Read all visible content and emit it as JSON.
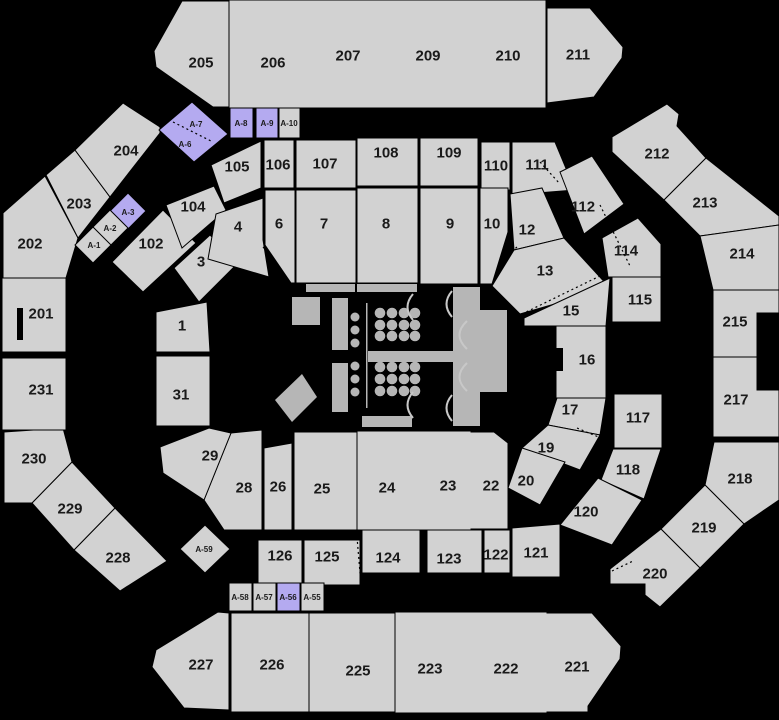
{
  "canvas": {
    "w": 779,
    "h": 720,
    "bg": "#000000"
  },
  "colors": {
    "g": "#d2d2d2",
    "p": "#b4aaf0",
    "stage": "#b6b6b6",
    "arc": "#c8c8c8",
    "label": "#1a1a1a",
    "border": "#000000"
  },
  "sections": [
    {
      "id": "205",
      "label": "205",
      "pts": "182,1 229,1 229,107 213,107 156,67 154,51",
      "lx": 201,
      "ly": 62,
      "fs": 15,
      "fill": "g"
    },
    {
      "id": "206",
      "label": "206",
      "pts": "230,1 310,1 310,107 230,107",
      "lx": 273,
      "ly": 62,
      "fs": 15,
      "fill": "g",
      "st": false
    },
    {
      "id": "207",
      "label": "207",
      "pts": "310,1 390,1 390,107 310,107",
      "lx": 348,
      "ly": 55,
      "fs": 15,
      "fill": "g",
      "st": false
    },
    {
      "id": "209",
      "label": "209",
      "pts": "390,1 465,1 465,107 390,107",
      "lx": 428,
      "ly": 55,
      "fs": 15,
      "fill": "g",
      "st": false
    },
    {
      "id": "210",
      "label": "210",
      "pts": "465,1 545,1 545,107 465,107",
      "lx": 508,
      "ly": 55,
      "fs": 15,
      "fill": "g",
      "st": false
    },
    {
      "id": "211",
      "label": "211",
      "pts": "547,8 590,8 623,47 622,58 594,97 547,103",
      "lx": 578,
      "ly": 54,
      "fs": 15,
      "fill": "g"
    },
    {
      "id": "212",
      "label": "212",
      "pts": "612,137 667,104 679,114 677,126 706,158 664,200 612,152",
      "lx": 657,
      "ly": 153,
      "fs": 15,
      "fill": "g"
    },
    {
      "id": "213",
      "label": "213",
      "pts": "706,158 664,200 700,236 779,225 779,216",
      "lx": 705,
      "ly": 202,
      "fs": 15,
      "fill": "g"
    },
    {
      "id": "214",
      "label": "214",
      "pts": "700,236 779,225 779,290 713,290",
      "lx": 742,
      "ly": 253,
      "fs": 15,
      "fill": "g"
    },
    {
      "id": "215",
      "label": "215",
      "pts": "713,290 779,290 779,313 757,313 757,357 713,357",
      "lx": 735,
      "ly": 321,
      "fs": 15,
      "fill": "g"
    },
    {
      "id": "217",
      "label": "217",
      "pts": "713,357 757,357 757,390 779,390 779,437 713,437",
      "lx": 736,
      "ly": 399,
      "fs": 15,
      "fill": "g"
    },
    {
      "id": "218",
      "label": "218",
      "pts": "714,442 779,442 779,500 744,524 705,485",
      "lx": 740,
      "ly": 478,
      "fs": 15,
      "fill": "g"
    },
    {
      "id": "219",
      "label": "219",
      "pts": "705,485 744,524 700,568 661,529",
      "lx": 704,
      "ly": 527,
      "fs": 15,
      "fill": "g"
    },
    {
      "id": "220",
      "label": "220",
      "pts": "661,529 700,568 660,607 645,595 645,584 610,584 610,569",
      "lx": 655,
      "ly": 573,
      "fs": 15,
      "fill": "g"
    },
    {
      "id": "221",
      "label": "221",
      "pts": "546,613 592,613 621,646 620,659 588,706 588,712 546,712",
      "lx": 577,
      "ly": 666,
      "fs": 15,
      "fill": "g"
    },
    {
      "id": "222",
      "label": "222",
      "pts": "470,613 546,613 546,712 470,712",
      "lx": 506,
      "ly": 668,
      "fs": 15,
      "fill": "g",
      "st": false
    },
    {
      "id": "223",
      "label": "223",
      "pts": "395,613 470,613 470,712 395,712",
      "lx": 430,
      "ly": 668,
      "fs": 15,
      "fill": "g",
      "st": false
    },
    {
      "id": "225",
      "label": "225",
      "pts": "309,613 395,613 395,712 309,712",
      "lx": 358,
      "ly": 670,
      "fs": 15,
      "fill": "g"
    },
    {
      "id": "226",
      "label": "226",
      "pts": "231,613 309,613 309,712 231,712",
      "lx": 272,
      "ly": 664,
      "fs": 15,
      "fill": "g"
    },
    {
      "id": "227",
      "label": "227",
      "pts": "218,612 229,613 229,710 184,708 152,667 156,650",
      "lx": 201,
      "ly": 664,
      "fs": 15,
      "fill": "g"
    },
    {
      "id": "228",
      "label": "228",
      "pts": "115,508 167,561 120,591 74,550",
      "lx": 118,
      "ly": 557,
      "fs": 15,
      "fill": "g"
    },
    {
      "id": "229",
      "label": "229",
      "pts": "72,462 115,508 74,550 32,503",
      "lx": 70,
      "ly": 508,
      "fs": 15,
      "fill": "g"
    },
    {
      "id": "230",
      "label": "230",
      "pts": "4,432 63,428 72,462 32,503 4,503",
      "lx": 34,
      "ly": 458,
      "fs": 15,
      "fill": "g"
    },
    {
      "id": "231",
      "label": "231",
      "pts": "2,358 66,358 66,430 2,430",
      "lx": 41,
      "ly": 389,
      "fs": 15,
      "fill": "g"
    },
    {
      "id": "201",
      "label": "201",
      "pts": "2,278 66,278 66,352 2,352",
      "lx": 41,
      "ly": 313,
      "fs": 15,
      "fill": "g"
    },
    {
      "id": "202",
      "label": "202",
      "pts": "3,213 45,176 78,238 66,278 3,278",
      "lx": 30,
      "ly": 243,
      "fs": 15,
      "fill": "g"
    },
    {
      "id": "203",
      "label": "203",
      "pts": "46,175 75,150 110,197 78,238",
      "lx": 79,
      "ly": 203,
      "fs": 15,
      "fill": "g"
    },
    {
      "id": "204",
      "label": "204",
      "pts": "75,150 123,103 160,127 160,133 110,197",
      "lx": 126,
      "ly": 150,
      "fs": 15,
      "fill": "g"
    },
    {
      "id": "105",
      "label": "105",
      "pts": "211,165 261,141 261,188 224,203",
      "lx": 237,
      "ly": 166,
      "fs": 15,
      "fill": "g"
    },
    {
      "id": "106",
      "label": "106",
      "pts": "264,140 294,140 294,188 264,188",
      "lx": 278,
      "ly": 164,
      "fs": 15,
      "fill": "g"
    },
    {
      "id": "107",
      "label": "107",
      "pts": "296,140 356,140 356,188 296,188",
      "lx": 325,
      "ly": 163,
      "fs": 15,
      "fill": "g"
    },
    {
      "id": "108",
      "label": "108",
      "pts": "357,138 418,138 418,186 357,186",
      "lx": 386,
      "ly": 152,
      "fs": 15,
      "fill": "g"
    },
    {
      "id": "109",
      "label": "109",
      "pts": "420,138 478,138 478,186 420,186",
      "lx": 449,
      "ly": 152,
      "fs": 15,
      "fill": "g"
    },
    {
      "id": "110",
      "label": "110",
      "pts": "481,142 510,142 510,190 481,190",
      "lx": 496,
      "ly": 165,
      "fs": 15,
      "fill": "g"
    },
    {
      "id": "111",
      "label": "111",
      "pts": "512,142 555,142 575,190 512,195",
      "lx": 537,
      "ly": 164,
      "fs": 15,
      "fill": "g"
    },
    {
      "id": "112",
      "label": "112",
      "pts": "560,172 592,156 624,204 584,234",
      "lx": 583,
      "ly": 206,
      "fs": 15,
      "fill": "g"
    },
    {
      "id": "114",
      "label": "114",
      "pts": "602,238 638,218 661,244 661,277 608,277",
      "lx": 626,
      "ly": 250,
      "fs": 15,
      "fill": "g"
    },
    {
      "id": "115",
      "label": "115",
      "pts": "612,277 661,277 661,322 612,322",
      "lx": 640,
      "ly": 299,
      "fs": 15,
      "fill": "g"
    },
    {
      "id": "117",
      "label": "117",
      "pts": "614,394 662,394 662,448 614,448",
      "lx": 638,
      "ly": 417,
      "fs": 15,
      "fill": "g"
    },
    {
      "id": "118",
      "label": "118",
      "pts": "613,449 661,449 644,499 601,480",
      "lx": 628,
      "ly": 469,
      "fs": 15,
      "fill": "g"
    },
    {
      "id": "120",
      "label": "120",
      "pts": "598,478 642,500 612,545 560,525",
      "lx": 586,
      "ly": 511,
      "fs": 15,
      "fill": "g"
    },
    {
      "id": "121",
      "label": "121",
      "pts": "512,528 560,524 560,577 512,577",
      "lx": 536,
      "ly": 552,
      "fs": 15,
      "fill": "g"
    },
    {
      "id": "122",
      "label": "122",
      "pts": "484,530 510,530 510,573 484,573",
      "lx": 496,
      "ly": 554,
      "fs": 15,
      "fill": "g"
    },
    {
      "id": "123",
      "label": "123",
      "pts": "427,530 482,530 482,573 427,573",
      "lx": 449,
      "ly": 558,
      "fs": 15,
      "fill": "g"
    },
    {
      "id": "124",
      "label": "124",
      "pts": "362,530 420,530 420,573 362,573",
      "lx": 388,
      "ly": 557,
      "fs": 15,
      "fill": "g"
    },
    {
      "id": "125",
      "label": "125",
      "pts": "304,540 360,540 360,585 304,585",
      "lx": 327,
      "ly": 556,
      "fs": 15,
      "fill": "g"
    },
    {
      "id": "126",
      "label": "126",
      "pts": "258,540 302,540 302,585 258,585",
      "lx": 280,
      "ly": 555,
      "fs": 15,
      "fill": "g"
    },
    {
      "id": "102",
      "label": "102",
      "pts": "112,262 163,210 196,243 143,292",
      "lx": 151,
      "ly": 243,
      "fs": 15,
      "fill": "g"
    },
    {
      "id": "104",
      "label": "104",
      "pts": "166,205 214,186 226,210 182,248",
      "lx": 193,
      "ly": 206,
      "fs": 15,
      "fill": "g"
    },
    {
      "id": "1",
      "label": "1",
      "pts": "156,312 207,302 210,352 156,352",
      "lx": 182,
      "ly": 325,
      "fs": 15,
      "fill": "g"
    },
    {
      "id": "3",
      "label": "3",
      "pts": "174,268 210,235 238,263 199,302",
      "lx": 201,
      "ly": 261,
      "fs": 15,
      "fill": "g"
    },
    {
      "id": "4",
      "label": "4",
      "pts": "216,214 263,198 263,240 269,277 208,259",
      "lx": 238,
      "ly": 226,
      "fs": 15,
      "fill": "g"
    },
    {
      "id": "6",
      "label": "6",
      "pts": "265,190 295,190 295,283 291,283 265,245",
      "lx": 279,
      "ly": 223,
      "fs": 15,
      "fill": "g"
    },
    {
      "id": "7",
      "label": "7",
      "pts": "296,190 356,190 356,283 296,283",
      "lx": 324,
      "ly": 223,
      "fs": 15,
      "fill": "g"
    },
    {
      "id": "8",
      "label": "8",
      "pts": "357,188 418,188 418,283 357,283",
      "lx": 386,
      "ly": 223,
      "fs": 15,
      "fill": "g"
    },
    {
      "id": "9",
      "label": "9",
      "pts": "420,188 478,188 478,284 420,284",
      "lx": 450,
      "ly": 223,
      "fs": 15,
      "fill": "g"
    },
    {
      "id": "10",
      "label": "10",
      "pts": "480,188 508,188 508,232 492,284 480,284",
      "lx": 492,
      "ly": 223,
      "fs": 15,
      "fill": "g"
    },
    {
      "id": "12",
      "label": "12",
      "pts": "510,194 542,188 564,238 514,250",
      "lx": 527,
      "ly": 229,
      "fs": 15,
      "fill": "g"
    },
    {
      "id": "13",
      "label": "13",
      "pts": "514,250 564,238 610,288 520,314 492,286",
      "lx": 545,
      "ly": 270,
      "fs": 15,
      "fill": "g"
    },
    {
      "id": "15",
      "label": "15",
      "pts": "524,318 610,278 606,326 524,326",
      "lx": 571,
      "ly": 310,
      "fs": 15,
      "fill": "g"
    },
    {
      "id": "16",
      "label": "16",
      "pts": "556,326 606,326 606,398 556,398",
      "lx": 587,
      "ly": 359,
      "fs": 15,
      "fill": "g"
    },
    {
      "id": "17",
      "label": "17",
      "pts": "557,398 606,398 600,435 548,425",
      "lx": 570,
      "ly": 409,
      "fs": 15,
      "fill": "g"
    },
    {
      "id": "19",
      "label": "19",
      "pts": "548,425 600,435 580,470 522,448",
      "lx": 546,
      "ly": 447,
      "fs": 15,
      "fill": "g"
    },
    {
      "id": "20",
      "label": "20",
      "pts": "522,448 565,462 540,505 508,488",
      "lx": 526,
      "ly": 480,
      "fs": 15,
      "fill": "g"
    },
    {
      "id": "22",
      "label": "22",
      "pts": "470,432 494,432 508,443 508,529 470,529",
      "lx": 491,
      "ly": 485,
      "fs": 15,
      "fill": "g"
    },
    {
      "id": "23",
      "label": "23",
      "pts": "420,432 470,432 470,529 420,529",
      "lx": 448,
      "ly": 485,
      "fs": 15,
      "fill": "g",
      "st": false
    },
    {
      "id": "24",
      "label": "24",
      "pts": "358,432 420,432 420,529 358,529",
      "lx": 387,
      "ly": 487,
      "fs": 15,
      "fill": "g",
      "st": false
    },
    {
      "id": "25",
      "label": "25",
      "pts": "294,432 357,432 357,530 294,530",
      "lx": 322,
      "ly": 488,
      "fs": 15,
      "fill": "g"
    },
    {
      "id": "26",
      "label": "26",
      "pts": "264,448 292,443 292,530 264,530",
      "lx": 278,
      "ly": 486,
      "fs": 15,
      "fill": "g"
    },
    {
      "id": "28",
      "label": "28",
      "pts": "231,433 262,430 262,530 224,530 204,500",
      "lx": 244,
      "ly": 487,
      "fs": 15,
      "fill": "g"
    },
    {
      "id": "29",
      "label": "29",
      "pts": "160,447 209,428 231,433 204,500 163,473",
      "lx": 210,
      "ly": 455,
      "fs": 15,
      "fill": "g"
    },
    {
      "id": "31",
      "label": "31",
      "pts": "156,356 210,356 210,426 156,426",
      "lx": 181,
      "ly": 394,
      "fs": 15,
      "fill": "g"
    },
    {
      "id": "A-7",
      "label": "A-7",
      "pts": "192,102 228,134 194,162 159,130",
      "lx": 196,
      "ly": 124,
      "fs": 8,
      "fill": "p"
    },
    {
      "id": "A-6",
      "label": "A-6",
      "pts": "192,102 228,134 194,162 159,130",
      "lx": 185,
      "ly": 144,
      "fs": 8,
      "fill": "none"
    },
    {
      "id": "A-8",
      "label": "A-8",
      "pts": "230,108 253,108 253,138 230,138",
      "lx": 241,
      "ly": 123,
      "fs": 8,
      "fill": "p"
    },
    {
      "id": "A-9",
      "label": "A-9",
      "pts": "256,108 278,108 278,138 256,138",
      "lx": 267,
      "ly": 123,
      "fs": 8,
      "fill": "p"
    },
    {
      "id": "A-10",
      "label": "A-10",
      "pts": "279,108 300,108 300,138 279,138",
      "lx": 289,
      "ly": 123,
      "fs": 8,
      "fill": "g"
    },
    {
      "id": "A-3",
      "label": "A-3",
      "pts": "128,193 146,211 128,229 110,211",
      "lx": 128,
      "ly": 212,
      "fs": 8,
      "fill": "p"
    },
    {
      "id": "A-2",
      "label": "A-2",
      "pts": "110,210 128,228 110,246 92,228",
      "lx": 110,
      "ly": 228,
      "fs": 8,
      "fill": "g"
    },
    {
      "id": "A-1",
      "label": "A-1",
      "pts": "93,227 111,245 93,263 75,245",
      "lx": 94,
      "ly": 245,
      "fs": 8,
      "fill": "g"
    },
    {
      "id": "A-59",
      "label": "A-59",
      "pts": "205,525 230,549 205,573 180,549",
      "lx": 204,
      "ly": 549,
      "fs": 8,
      "fill": "g"
    },
    {
      "id": "A-58",
      "label": "A-58",
      "pts": "229,583 252,583 252,611 229,611",
      "lx": 240,
      "ly": 597,
      "fs": 8,
      "fill": "g"
    },
    {
      "id": "A-57",
      "label": "A-57",
      "pts": "253,583 276,583 276,611 253,611",
      "lx": 264,
      "ly": 597,
      "fs": 8,
      "fill": "g"
    },
    {
      "id": "A-56",
      "label": "A-56",
      "pts": "277,583 300,583 300,611 277,611",
      "lx": 288,
      "ly": 597,
      "fs": 8,
      "fill": "p"
    },
    {
      "id": "A-55",
      "label": "A-55",
      "pts": "301,583 324,583 324,611 301,611",
      "lx": 312,
      "ly": 597,
      "fs": 8,
      "fill": "g"
    }
  ],
  "stage": {
    "rects": [
      {
        "x": 306,
        "y": 284,
        "w": 49,
        "h": 8
      },
      {
        "x": 357,
        "y": 284,
        "w": 60,
        "h": 8
      },
      {
        "x": 292,
        "y": 297,
        "w": 28,
        "h": 28
      },
      {
        "x": 332,
        "y": 298,
        "w": 16,
        "h": 52
      },
      {
        "x": 332,
        "y": 363,
        "w": 16,
        "h": 49
      },
      {
        "x": 366,
        "y": 303,
        "w": 1.5,
        "h": 105
      },
      {
        "x": 368,
        "y": 351,
        "w": 86,
        "h": 11
      },
      {
        "x": 453,
        "y": 287,
        "w": 27,
        "h": 139
      },
      {
        "x": 480,
        "y": 310,
        "w": 27,
        "h": 82
      },
      {
        "x": 362,
        "y": 416,
        "w": 50,
        "h": 11
      }
    ],
    "diamond": "275,400 302,374 317,397 292,422",
    "small_circles": {
      "x": 355,
      "r": 4.5,
      "ys": [
        317,
        330,
        343,
        366,
        379,
        392
      ]
    },
    "table_circles": {
      "cols": [
        380,
        392,
        404,
        415
      ],
      "rows": [
        313,
        325,
        336,
        367,
        379,
        391
      ],
      "r": 5.3
    },
    "arcs": [
      "M413,294 Q402,307 413,320",
      "M413,392 Q402,405 413,418",
      "M452,291 Q441,304 452,317",
      "M452,395 Q441,408 452,421",
      "M467,321 Q452,335 467,349",
      "M467,363 Q452,377 467,391"
    ]
  },
  "black_overlays": [
    {
      "x": 507,
      "y": 348,
      "w": 56,
      "h": 23
    },
    {
      "x": 17,
      "y": 308,
      "w": 6,
      "h": 32
    }
  ],
  "dashed_lines": [
    {
      "x1": 173,
      "y1": 122,
      "x2": 213,
      "y2": 142
    },
    {
      "x1": 112,
      "y1": 99,
      "x2": 143,
      "y2": 79
    },
    {
      "x1": 163,
      "y1": 442,
      "x2": 197,
      "y2": 430
    },
    {
      "x1": 265,
      "y1": 447,
      "x2": 290,
      "y2": 443
    },
    {
      "x1": 421,
      "y1": 532,
      "x2": 427,
      "y2": 573
    },
    {
      "x1": 357,
      "y1": 537,
      "x2": 361,
      "y2": 585
    },
    {
      "x1": 577,
      "y1": 428,
      "x2": 608,
      "y2": 441
    },
    {
      "x1": 540,
      "y1": 162,
      "x2": 560,
      "y2": 184
    },
    {
      "x1": 500,
      "y1": 261,
      "x2": 517,
      "y2": 247
    },
    {
      "x1": 522,
      "y1": 314,
      "x2": 604,
      "y2": 274
    },
    {
      "x1": 612,
      "y1": 571,
      "x2": 633,
      "y2": 561
    },
    {
      "x1": 263,
      "y1": 247,
      "x2": 276,
      "y2": 261
    },
    {
      "x1": 600,
      "y1": 205,
      "x2": 630,
      "y2": 266
    }
  ]
}
